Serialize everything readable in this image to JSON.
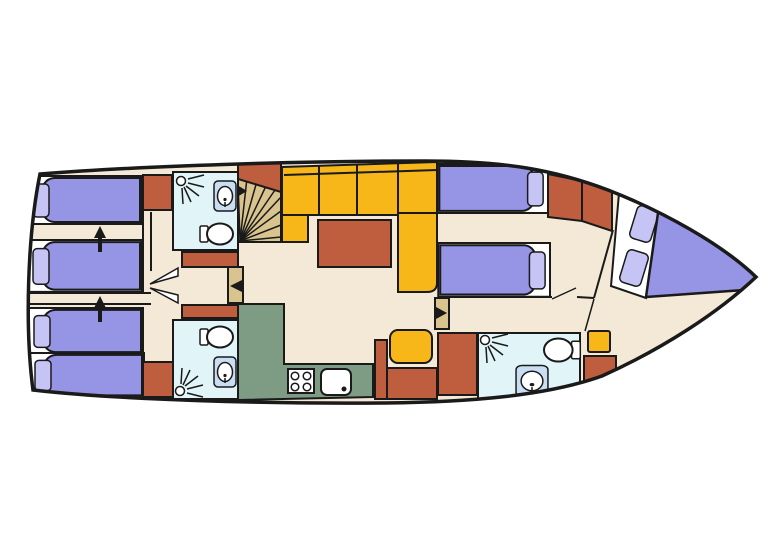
{
  "meta": {
    "type": "boat-deck-floor-plan",
    "orientation": {
      "bow": "right",
      "stern": "left"
    },
    "berths": {
      "single_beds": 6,
      "double_v_berths": 1
    }
  },
  "colors": {
    "background": "#ffffff",
    "outline": "#1a1a1a",
    "floor": "#f4e8d7",
    "bed": "#9694e4",
    "pillow": "#c6c4f4",
    "platform": "#ffffff",
    "wood": "#bf5d3f",
    "sofa": "#f7b719",
    "galley": "#7e9c84",
    "bath": "#e1f4f8",
    "stairs": "#d9c48f",
    "sink": "#c9def2",
    "white": "#ffffff"
  },
  "legend": {
    "floor": "walkways and cabin floor",
    "bed": "mattresses / upholstery",
    "wood": "wardrobes, table, benches",
    "sofa": "L-shaped settee and stools",
    "galley": "kitchen counter",
    "bath": "wet rooms (shower, toilet, sink)",
    "stairs": "companionway spiral steps"
  },
  "rooms": [
    {
      "name": "aft-cabin-upper",
      "furniture": [
        "single-bed",
        "single-bed",
        "wardrobe",
        "convert-arrow"
      ]
    },
    {
      "name": "aft-cabin-lower",
      "furniture": [
        "single-bed",
        "single-bed",
        "wardrobe",
        "convert-arrow"
      ]
    },
    {
      "name": "aft-bathroom-upper",
      "furniture": [
        "shower",
        "sink",
        "toilet"
      ]
    },
    {
      "name": "aft-bathroom-lower",
      "furniture": [
        "toilet",
        "sink",
        "shower"
      ]
    },
    {
      "name": "companionway",
      "furniture": [
        "spiral-stairs",
        "door"
      ]
    },
    {
      "name": "salon",
      "furniture": [
        "l-shaped-sofa",
        "table",
        "stool",
        "bench"
      ]
    },
    {
      "name": "galley",
      "furniture": [
        "counter",
        "stove",
        "sink"
      ]
    },
    {
      "name": "mid-cabin",
      "furniture": [
        "single-bed",
        "single-bed",
        "wardrobe",
        "door"
      ]
    },
    {
      "name": "bow-bathroom",
      "furniture": [
        "shower",
        "toilet",
        "sink"
      ]
    },
    {
      "name": "bow-cabin",
      "furniture": [
        "double-v-berth",
        "stool",
        "wardrobe"
      ]
    }
  ]
}
